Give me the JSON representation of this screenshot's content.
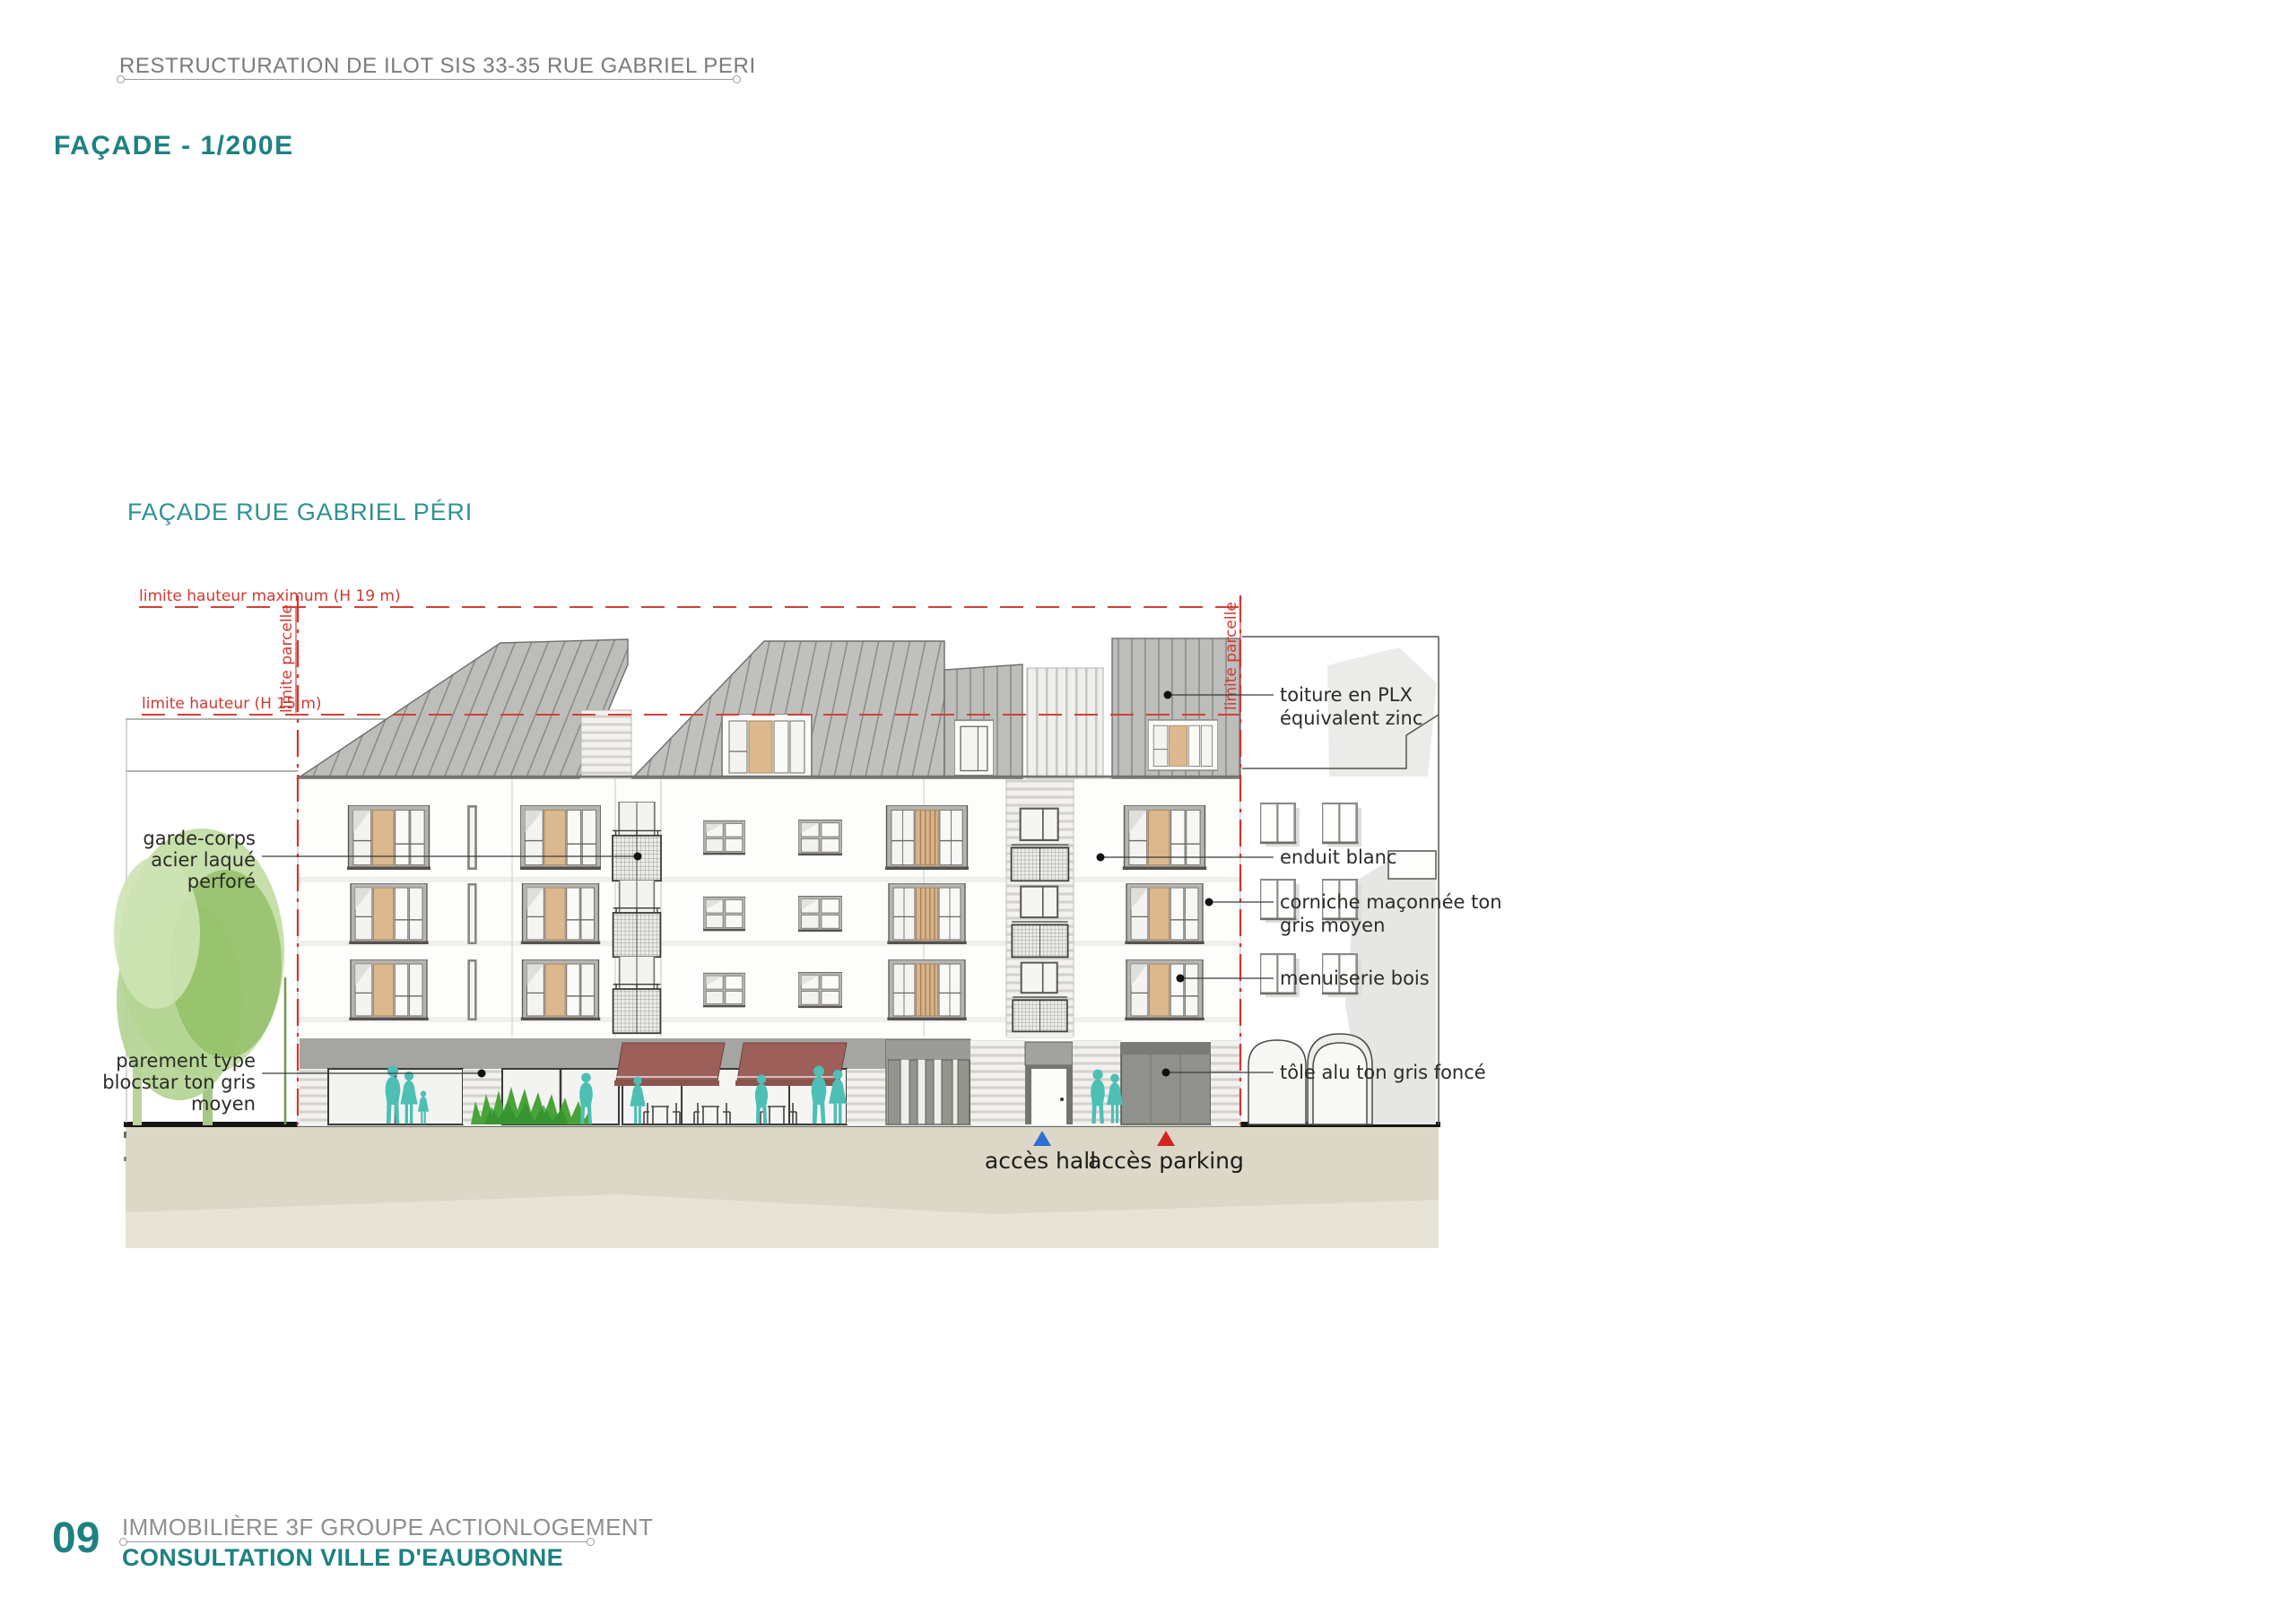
{
  "sheet": {
    "project_title": "RESTRUCTURATION DE ILOT SIS 33-35 RUE GABRIEL PERI",
    "view_title": "FAÇADE - 1/200E",
    "footer": {
      "page_number": "09",
      "org_line": "IMMOBILIÈRE 3F GROUPE ACTIONLOGEMENT",
      "consultation_line": "CONSULTATION VILLE D'EAUBONNE"
    }
  },
  "drawing": {
    "subtitle": "FAÇADE RUE GABRIEL PÉRI",
    "limits": {
      "h19": "limite hauteur maximum (H 19 m)",
      "h15": "limite hauteur (H 15 m)",
      "parcel_left": "limite parcelle",
      "parcel_right": "limite parcelle"
    },
    "annotations": {
      "garde_corps_1": "garde-corps",
      "garde_corps_2": "acier laqué",
      "garde_corps_3": "perforé",
      "parement_1": "parement type",
      "parement_2": "blocstar ton gris",
      "parement_3": "moyen",
      "toiture_1": "toiture en PLX",
      "toiture_2": "équivalent zinc",
      "enduit": "enduit blanc",
      "corniche_1": "corniche maçonnée ton",
      "corniche_2": "gris moyen",
      "menuiserie": "menuiserie bois",
      "tole": "tôle alu ton gris foncé"
    },
    "access": {
      "hall": "accès hall",
      "parking": "accès parking"
    }
  },
  "colors": {
    "accent_teal": "#1e8181",
    "annotation_red": "#d0382e",
    "hall_arrow_blue": "#2d6fd4",
    "parking_arrow_red": "#d42420",
    "people_teal": "#4dbfb5",
    "roof_gray": "#bcbcba",
    "awning_maroon": "#9c5f5a",
    "wood_tan": "#dcb88e",
    "ground_beige": "#dcd7c7"
  }
}
